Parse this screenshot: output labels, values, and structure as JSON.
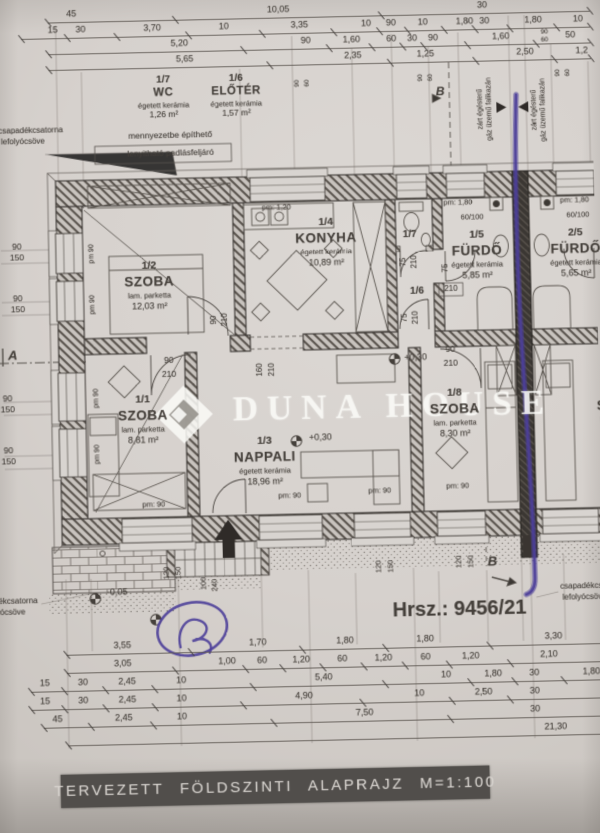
{
  "title_block": {
    "text": "TERVEZETT FÖLDSZINTI ALAPRAJZ M=1:100"
  },
  "watermark": {
    "text": "DUNA HOUSE"
  },
  "plot": {
    "label": "Hrsz.: 9456/21"
  },
  "colors": {
    "paper": "#d6d1cd",
    "ink": "#45403b",
    "pen_mark": "#4c3f99",
    "title_bg": "#514e4b"
  },
  "legend_rooms": [
    {
      "num": "1/7",
      "name": "WC",
      "material": "égetett kerámia",
      "area": "1,26 m²",
      "cx": 170,
      "cy": 76
    },
    {
      "num": "1/6",
      "name": "ELŐTÉR",
      "material": "égetett kerámia",
      "area": "1,57 m²",
      "cx": 243,
      "cy": 76
    }
  ],
  "rooms": [
    {
      "num": "1/2",
      "name": "SZOBA",
      "material": "lam. parketta",
      "area": "12,03 m²",
      "cx": 152,
      "cy": 262
    },
    {
      "num": "1/4",
      "name": "KONYHA",
      "material": "égetett kerámia",
      "area": "10,89 m²",
      "cx": 330,
      "cy": 222
    },
    {
      "num": "1/5",
      "name": "FÜRDŐ",
      "material": "égetett kerámia",
      "area": "5,85 m²",
      "cx": 481,
      "cy": 238
    },
    {
      "num": "2/5",
      "name": "FÜRDŐ",
      "material": "égetett kerámia",
      "area": "5,65 m²",
      "cx": 580,
      "cy": 238
    },
    {
      "num": "1/1",
      "name": "SZOBA",
      "material": "lam. parketta",
      "area": "8,81 m²",
      "cx": 143,
      "cy": 396
    },
    {
      "num": "1/3",
      "name": "NAPPALI",
      "material": "égetett kerámia",
      "area": "18,96 m²",
      "cx": 264,
      "cy": 440
    },
    {
      "num": "1/8",
      "name": "SZOBA",
      "material": "lam. parketta",
      "area": "8,30 m²",
      "cx": 455,
      "cy": 396
    },
    {
      "num": "",
      "name": "SZOBA",
      "material": "lam. parketta",
      "area": "",
      "cx": 622,
      "cy": 396
    }
  ],
  "dimensions": {
    "top": [
      {
        "y": 7,
        "ly": 15,
        "x0": 55,
        "x1": 600,
        "items": [
          {
            "t": "45",
            "x": 79
          },
          {
            "t": "10,05",
            "x": 287
          },
          {
            "t": "30",
            "x": 492
          }
        ]
      },
      {
        "y": 23,
        "ly": 31,
        "x0": 28,
        "x1": 600,
        "items": [
          {
            "t": "15",
            "x": 60
          },
          {
            "t": "30",
            "x": 88
          },
          {
            "t": "3,70",
            "x": 160
          },
          {
            "t": "10",
            "x": 232
          },
          {
            "t": "3,35",
            "x": 308
          },
          {
            "t": "10",
            "x": 375
          },
          {
            "t": "90",
            "x": 400
          },
          {
            "t": "10",
            "x": 432
          },
          {
            "t": "1,80",
            "x": 474
          },
          {
            "t": "30",
            "x": 494
          },
          {
            "t": "1,80",
            "x": 543
          },
          {
            "t": "10",
            "x": 588
          }
        ]
      },
      {
        "y": 39,
        "ly": 47,
        "x0": 55,
        "x1": 600,
        "items": [
          {
            "t": "5,20",
            "x": 187
          },
          {
            "t": "90",
            "x": 314
          },
          {
            "t": "1,60",
            "x": 360
          },
          {
            "t": "60",
            "x": 400
          },
          {
            "t": "30",
            "x": 421
          },
          {
            "t": "90",
            "x": 442
          },
          {
            "t": "1,60",
            "x": 510
          },
          {
            "t": "50",
            "x": 580
          }
        ]
      },
      {
        "y": 55,
        "ly": 63,
        "x0": 55,
        "x1": 600,
        "items": [
          {
            "t": "5,65",
            "x": 192
          },
          {
            "t": "2,35",
            "x": 361
          },
          {
            "t": "1,25",
            "x": 434
          },
          {
            "t": "2,50",
            "x": 534
          },
          {
            "t": "1,2",
            "x": 591
          }
        ]
      }
    ],
    "bottom": [
      {
        "y": 641,
        "ly": 649,
        "x0": 62,
        "x1": 600,
        "items": [
          {
            "t": "3,55",
            "x": 118
          },
          {
            "t": "1,70",
            "x": 253
          },
          {
            "t": "1,80",
            "x": 340
          },
          {
            "t": "1,80",
            "x": 420
          },
          {
            "t": "3,30",
            "x": 548
          }
        ]
      },
      {
        "y": 659,
        "ly": 667,
        "x0": 62,
        "x1": 600,
        "items": [
          {
            "t": "3,05",
            "x": 118
          },
          {
            "t": "1,00",
            "x": 222
          },
          {
            "t": "60",
            "x": 257
          },
          {
            "t": "1,20",
            "x": 296
          },
          {
            "t": "60",
            "x": 337
          },
          {
            "t": "1,20",
            "x": 378
          },
          {
            "t": "60",
            "x": 420
          },
          {
            "t": "1,20",
            "x": 465
          },
          {
            "t": "2,10",
            "x": 543
          }
        ]
      },
      {
        "y": 677,
        "ly": 685,
        "x0": 26,
        "x1": 600,
        "items": [
          {
            "t": "15",
            "x": 40
          },
          {
            "t": "30",
            "x": 78
          },
          {
            "t": "2,45",
            "x": 122
          },
          {
            "t": "10",
            "x": 176
          },
          {
            "t": "5,40",
            "x": 318
          },
          {
            "t": "10",
            "x": 440
          },
          {
            "t": "1,80",
            "x": 487
          },
          {
            "t": "30",
            "x": 528
          },
          {
            "t": "1,80",
            "x": 585
          }
        ]
      },
      {
        "y": 695,
        "ly": 703,
        "x0": 26,
        "x1": 600,
        "items": [
          {
            "t": "15",
            "x": 40
          },
          {
            "t": "30",
            "x": 78
          },
          {
            "t": "2,45",
            "x": 122
          },
          {
            "t": "10",
            "x": 176
          },
          {
            "t": "4,90",
            "x": 298
          },
          {
            "t": "10",
            "x": 413
          },
          {
            "t": "2,50",
            "x": 477
          },
          {
            "t": "30",
            "x": 528
          }
        ]
      },
      {
        "y": 713,
        "ly": 721,
        "x0": 38,
        "x1": 600,
        "items": [
          {
            "t": "45",
            "x": 52
          },
          {
            "t": "2,45",
            "x": 118
          },
          {
            "t": "10",
            "x": 176
          },
          {
            "t": "7,50",
            "x": 358
          },
          {
            "t": "30",
            "x": 528
          }
        ]
      },
      {
        "y": 731,
        "ly": 739,
        "x0": 62,
        "x1": 600,
        "items": [
          {
            "t": "21,30",
            "x": 548
          }
        ]
      }
    ]
  },
  "labels": [
    {
      "n": "note-drainpipe-topleft-1",
      "t": "csapadékcsatorna",
      "x": 36,
      "y": 124,
      "fs": 8
    },
    {
      "n": "note-drainpipe-topleft-2",
      "t": "lefolyócsöve",
      "x": 28,
      "y": 135,
      "fs": 8
    },
    {
      "n": "note-attic-1",
      "t": "mennyezetbe építhető",
      "x": 176,
      "y": 131,
      "fs": 8.5
    },
    {
      "n": "note-attic-2",
      "t": "lenyitható padlásfeljáró",
      "x": 176,
      "y": 149,
      "fs": 8.5
    },
    {
      "n": "note-boiler-left-1",
      "t": "zárt égésterű",
      "x": 488,
      "y": 112,
      "fs": 7,
      "rot": -90
    },
    {
      "n": "note-boiler-left-2",
      "t": "gáz üzemű falikazán",
      "x": 497,
      "y": 112,
      "fs": 7,
      "rot": -90
    },
    {
      "n": "note-boiler-right-1",
      "t": "zárt égésterű",
      "x": 542,
      "y": 114,
      "fs": 7,
      "rot": -90
    },
    {
      "n": "note-boiler-right-2",
      "t": "gáz üzemű falikazán",
      "x": 551,
      "y": 114,
      "fs": 7,
      "rot": -90
    },
    {
      "n": "section-marker-b-top",
      "t": "B",
      "x": 448,
      "y": 93,
      "fs": 12,
      "b": 1,
      "i": 1
    },
    {
      "n": "section-marker-b-bottom",
      "t": "B",
      "x": 489,
      "y": 565,
      "fs": 13,
      "b": 1,
      "i": 1
    },
    {
      "n": "section-marker-a",
      "t": "A",
      "x": 14,
      "y": 349,
      "fs": 13,
      "b": 1,
      "i": 1
    },
    {
      "n": "window-dim",
      "t": "90",
      "x": 305,
      "y": 82,
      "fs": 6.5,
      "rot": -90
    },
    {
      "n": "window-dim",
      "t": "60",
      "x": 315,
      "y": 82,
      "fs": 6.5,
      "rot": -90
    },
    {
      "n": "window-dim",
      "t": "90",
      "x": 429,
      "y": 79,
      "fs": 6.5,
      "rot": -90
    },
    {
      "n": "window-dim",
      "t": "60",
      "x": 439,
      "y": 79,
      "fs": 6.5,
      "rot": -90
    },
    {
      "n": "window-dim",
      "t": "90",
      "x": 567,
      "y": 77,
      "fs": 6.5,
      "rot": -90
    },
    {
      "n": "window-dim",
      "t": "60",
      "x": 577,
      "y": 77,
      "fs": 6.5,
      "rot": -90
    },
    {
      "n": "window-dim",
      "t": "90",
      "x": 554,
      "y": 36,
      "fs": 6.5
    },
    {
      "n": "window-dim",
      "t": "60",
      "x": 554,
      "y": 44,
      "fs": 6.5
    },
    {
      "n": "sill-height",
      "t": "pm:  1,20",
      "x": 281,
      "y": 206,
      "fs": 7.5
    },
    {
      "n": "sill-height",
      "t": "pm:  1,80",
      "x": 463,
      "y": 205,
      "fs": 7.5
    },
    {
      "n": "sill-height",
      "t": "pm:  1,80",
      "x": 580,
      "y": 205,
      "fs": 7.5
    },
    {
      "n": "sill-height",
      "t": "pm  90",
      "x": 95,
      "y": 249,
      "fs": 7,
      "rot": -90
    },
    {
      "n": "sill-height",
      "t": "pm  90",
      "x": 95,
      "y": 300,
      "fs": 7,
      "rot": -90
    },
    {
      "n": "sill-height",
      "t": "pm  90",
      "x": 97,
      "y": 394,
      "fs": 7,
      "rot": -90
    },
    {
      "n": "sill-height",
      "t": "pm  90",
      "x": 97,
      "y": 450,
      "fs": 7,
      "rot": -90
    },
    {
      "n": "sill-height",
      "t": "pm:  90",
      "x": 152,
      "y": 501,
      "fs": 7.5
    },
    {
      "n": "sill-height",
      "t": "pm:  90",
      "x": 288,
      "y": 495,
      "fs": 7.5
    },
    {
      "n": "sill-height",
      "t": "pm:  90",
      "x": 378,
      "y": 492,
      "fs": 7.5
    },
    {
      "n": "sill-height",
      "t": "pm:  90",
      "x": 456,
      "y": 489,
      "fs": 7.5
    },
    {
      "n": "window-dim",
      "t": "90",
      "x": 20,
      "y": 240,
      "fs": 8.5
    },
    {
      "n": "window-dim",
      "t": "150",
      "x": 20,
      "y": 251,
      "fs": 8.5
    },
    {
      "n": "window-dim",
      "t": "90",
      "x": 20,
      "y": 292,
      "fs": 8.5
    },
    {
      "n": "window-dim",
      "t": "150",
      "x": 20,
      "y": 303,
      "fs": 8.5
    },
    {
      "n": "window-dim",
      "t": "90",
      "x": 8,
      "y": 392,
      "fs": 8.5
    },
    {
      "n": "window-dim",
      "t": "150",
      "x": 8,
      "y": 403,
      "fs": 8.5
    },
    {
      "n": "window-dim",
      "t": "90",
      "x": 8,
      "y": 444,
      "fs": 8.5
    },
    {
      "n": "window-dim",
      "t": "150",
      "x": 8,
      "y": 455,
      "fs": 8.5
    },
    {
      "n": "window-dim",
      "t": "60/100",
      "x": 477,
      "y": 220,
      "fs": 7.5
    },
    {
      "n": "window-dim",
      "t": "60/100",
      "x": 583,
      "y": 220,
      "fs": 7.5
    },
    {
      "n": "door-dim",
      "t": "90",
      "x": 216,
      "y": 318,
      "fs": 8,
      "rot": -90
    },
    {
      "n": "door-dim",
      "t": "210",
      "x": 227,
      "y": 318,
      "fs": 8,
      "rot": -90
    },
    {
      "n": "door-dim",
      "t": "90",
      "x": 170,
      "y": 357,
      "fs": 8.5
    },
    {
      "n": "door-dim",
      "t": "210",
      "x": 170,
      "y": 371,
      "fs": 8.5
    },
    {
      "n": "door-dim",
      "t": "90",
      "x": 452,
      "y": 352,
      "fs": 8.5
    },
    {
      "n": "door-dim",
      "t": "210",
      "x": 452,
      "y": 366,
      "fs": 8.5
    },
    {
      "n": "door-dim",
      "t": "160",
      "x": 261,
      "y": 369,
      "fs": 8,
      "rot": -90
    },
    {
      "n": "door-dim",
      "t": "210",
      "x": 273,
      "y": 369,
      "fs": 8,
      "rot": -90
    },
    {
      "n": "door-dim",
      "t": "75",
      "x": 407,
      "y": 264,
      "fs": 8,
      "rot": -90
    },
    {
      "n": "door-dim",
      "t": "210",
      "x": 418,
      "y": 264,
      "fs": 8,
      "rot": -90
    },
    {
      "n": "door-dim",
      "t": "75",
      "x": 407,
      "y": 320,
      "fs": 8,
      "rot": -90
    },
    {
      "n": "door-dim",
      "t": "210",
      "x": 418,
      "y": 320,
      "fs": 8,
      "rot": -90
    },
    {
      "n": "door-dim",
      "t": "75",
      "x": 449,
      "y": 271,
      "fs": 8,
      "rot": -90
    },
    {
      "n": "door-dim",
      "t": "210",
      "x": 454,
      "y": 292,
      "fs": 8
    },
    {
      "n": "room-number-17",
      "t": "1/7",
      "x": 414,
      "y": 237,
      "fs": 10,
      "b": 1
    },
    {
      "n": "room-number-16",
      "t": "1/6",
      "x": 420,
      "y": 294,
      "fs": 10,
      "b": 1
    },
    {
      "n": "level-mark",
      "t": "+0,30",
      "x": 320,
      "y": 438,
      "fs": 9
    },
    {
      "n": "level-mark",
      "t": "+0,30",
      "x": 417,
      "y": 360,
      "fs": 9
    },
    {
      "n": "level-mark",
      "t": "-0,05",
      "x": 114,
      "y": 588,
      "fs": 9
    },
    {
      "n": "plot-number",
      "t": "Hrsz.: 9456/21",
      "x": 455,
      "y": 612,
      "fs": 20,
      "b": 1
    },
    {
      "n": "note-drainpipe-bottomleft-1",
      "t": "csapadékcsatorna",
      "x": 2,
      "y": 595,
      "fs": 8
    },
    {
      "n": "note-drainpipe-bottomleft-2",
      "t": "lefolyócsöve",
      "x": 0,
      "y": 606,
      "fs": 8
    },
    {
      "n": "note-drainpipe-bottomright-1",
      "t": "csapadékcsatorna",
      "x": 556,
      "y": 592,
      "fs": 8,
      "al": "l"
    },
    {
      "n": "note-drainpipe-bottomright-2",
      "t": "lefolyócsöve",
      "x": 558,
      "y": 603,
      "fs": 8,
      "al": "l"
    },
    {
      "n": "step-dim",
      "t": "100",
      "x": 200,
      "y": 581,
      "fs": 7.5,
      "rot": -90
    },
    {
      "n": "step-dim",
      "t": "240",
      "x": 211,
      "y": 583,
      "fs": 7.5,
      "rot": -90
    },
    {
      "n": "window-dim",
      "t": "120",
      "x": 163,
      "y": 570,
      "fs": 7.5,
      "rot": -90
    },
    {
      "n": "window-dim",
      "t": "150",
      "x": 175,
      "y": 570,
      "fs": 7.5,
      "rot": -90
    },
    {
      "n": "window-dim",
      "t": "120",
      "x": 375,
      "y": 568,
      "fs": 7.5,
      "rot": -90
    },
    {
      "n": "window-dim",
      "t": "150",
      "x": 387,
      "y": 568,
      "fs": 7.5,
      "rot": -90
    },
    {
      "n": "window-dim",
      "t": "120",
      "x": 455,
      "y": 565,
      "fs": 7.5,
      "rot": -90
    },
    {
      "n": "window-dim",
      "t": "150",
      "x": 467,
      "y": 565,
      "fs": 7.5,
      "rot": -90
    }
  ]
}
